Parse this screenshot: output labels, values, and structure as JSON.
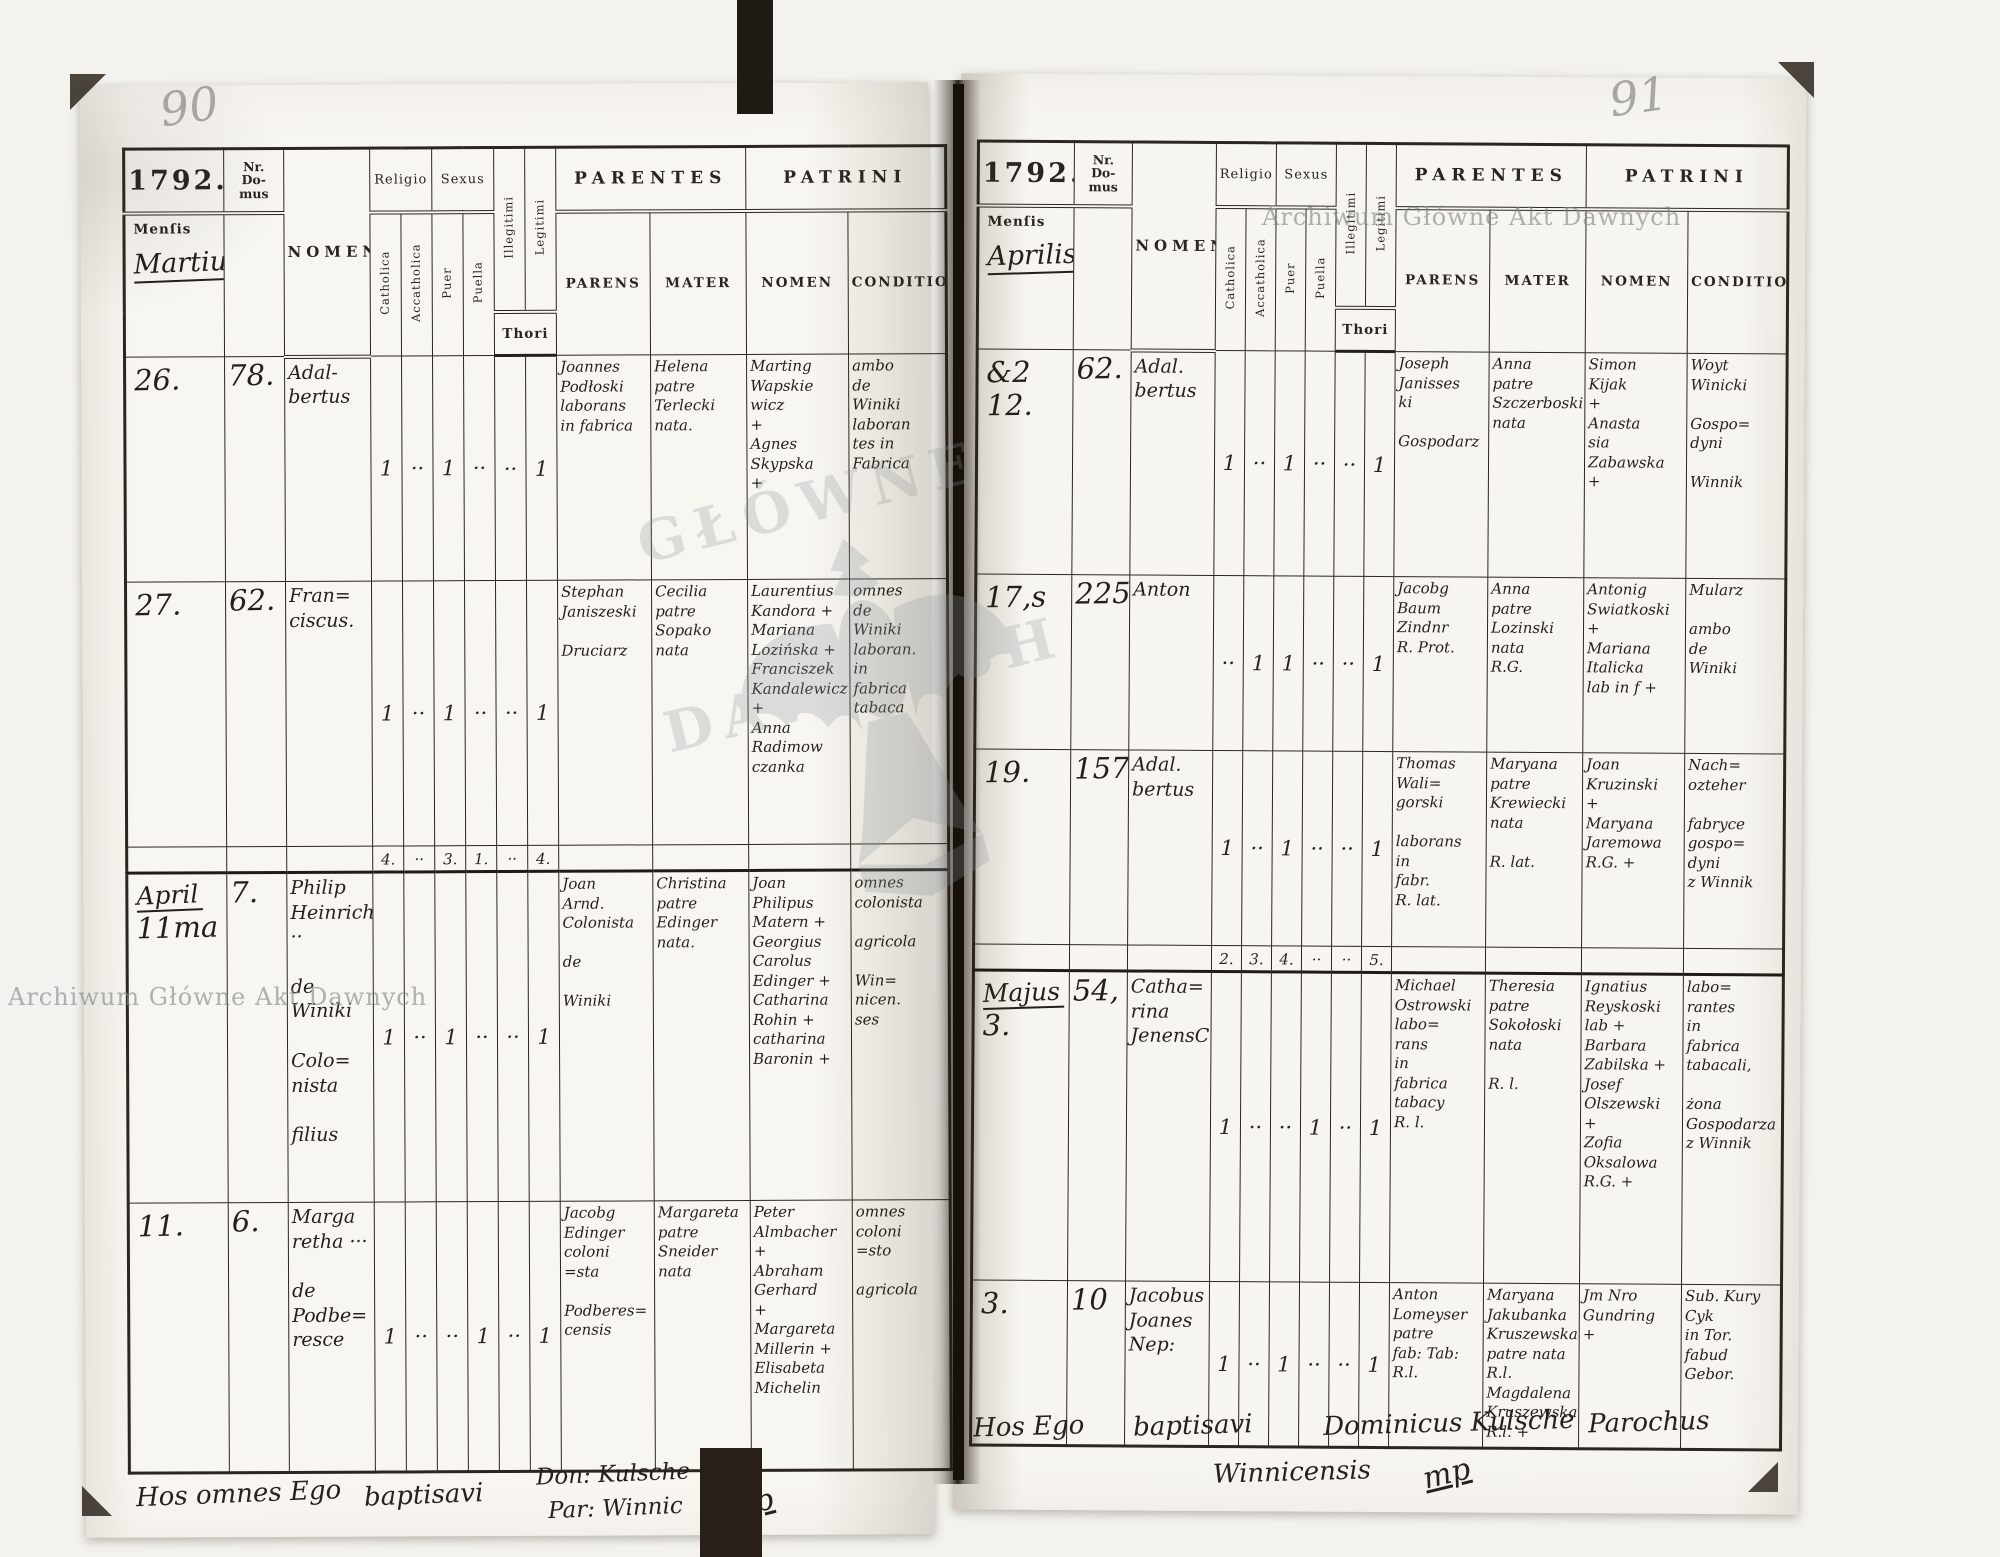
{
  "watermark": {
    "archive_name": "Archiwum Główne Akt Dawnych",
    "ghost_word_1": "GŁÓWNE",
    "ghost_word_2": "DAWNYCH"
  },
  "form_labels": {
    "year": "1792.",
    "nr_domus": "Nr.\nDo-\nmus",
    "mensis": "Menſis",
    "nomen": "NOMEN",
    "religio": "Religio",
    "sexus": "Sexus",
    "catholica": "Catholica",
    "accatholica": "Accatholica",
    "puer": "Puer",
    "puella": "Puella",
    "illegitimi": "Illegitimi",
    "legitimi": "Legitimi",
    "thori": "Thori",
    "parentes": "PARENTES",
    "parens": "PARENS",
    "mater": "MATER",
    "patrini": "PATRINI",
    "patrini_nomen": "NOMEN",
    "conditio": "CONDITIO"
  },
  "left_page": {
    "page_number": "90",
    "month": "Martius",
    "rows": [
      {
        "mensis": "26.",
        "nr": "78.",
        "nomen": "Adal-\nbertus",
        "tally": [
          "1",
          "··",
          "1",
          "··",
          "··",
          "1"
        ],
        "parens": "Joannes\nPodłoski\nlaborans\nin fabrica",
        "mater": "Helena\npatre\nTerlecki\nnata.",
        "patrini_nomen": "Marting\nWapskie\nwicz\n+\nAgnes\nSkypska\n+",
        "conditio": "ambo\nde\nWiniki\nlaboran\ntes in\nFabrica"
      },
      {
        "mensis": "27.",
        "nr": "62.",
        "nomen": "Fran=\nciscus.",
        "tally": [
          "1",
          "··",
          "1",
          "··",
          "··",
          "1"
        ],
        "parens": "Stephan\nJaniszeski\n\nDruciarz",
        "mater": "Cecilia\npatre\nSopako\nnata",
        "patrini_nomen": "Laurentius\nKandora +\nMariana\nLozińska +\nFranciszek\nKandalewicz\n+\nAnna\nRadimow\nczanka",
        "conditio": "omnes\nde\nWiniki\nlaboran.\nin\nfabrica\ntabaca"
      },
      {
        "mensis_month": "April",
        "mensis": "11ma",
        "nr": "7.",
        "nomen": "Philip\nHeinrich ··\n\nde\nWiniki\n\nColo=\nnista\n\nfilius",
        "tally": [
          "1",
          "··",
          "1",
          "··",
          "··",
          "1"
        ],
        "parens": "Joan\nArnd.\nColonista\n\nde\n\nWiniki",
        "mater": "Christina\npatre\nEdinger\nnata.",
        "patrini_nomen": "Joan\nPhilipus\nMatern +\nGeorgius\nCarolus\nEdinger +\nCatharina\nRohin +\ncatharina\nBaronin +",
        "conditio": "omnes\ncolonista\n\nagricola\n\nWin=\nnicen.\nses"
      },
      {
        "mensis": "11.",
        "nr": "6.",
        "nomen": "Marga\nretha ···\n\nde\nPodbe=\nresce",
        "tally": [
          "1",
          "··",
          "··",
          "1",
          "··",
          "1"
        ],
        "parens": "Jacobg\nEdinger\ncoloni\n=sta\n\nPodberes=\ncensis",
        "mater": "Margareta\npatre\nSneider\nnata",
        "patrini_nomen": "Peter\nAlmbacher\n+\nAbraham\nGerhard\n+\nMargareta\nMillerin +\nElisabeta\nMichelin",
        "conditio": "omnes\ncoloni\n=sto\n\nagricola"
      }
    ],
    "totals": [
      "4.",
      "··",
      "3.",
      "1.",
      "··",
      "4."
    ],
    "closing": {
      "p1": "Hos omnes Ego",
      "p2": "baptisavi",
      "p3": "Don: Kulsche",
      "p4": "Par: Winnic",
      "flourish": "mp"
    }
  },
  "right_page": {
    "page_number": "91",
    "month": "Aprilis",
    "rows": [
      {
        "mensis": "&2\n12.",
        "nr": "62.",
        "nomen": "Adal.\nbertus",
        "tally": [
          "1",
          "··",
          "1",
          "··",
          "··",
          "1"
        ],
        "parens": "Joseph\nJanisses\nki\n\nGospodarz",
        "mater": "Anna\npatre\nSzczerboski\nnata",
        "patrini_nomen": "Simon\nKijak\n+\nAnasta\nsia\nZabawska\n+",
        "conditio": "Woyt\nWinicki\n\nGospo=\ndyni\n\nWinnik"
      },
      {
        "mensis": "17,s",
        "nr": "225",
        "nomen": "Anton",
        "tally": [
          "··",
          "1",
          "1",
          "··",
          "··",
          "1"
        ],
        "parens": "Jacobg\nBaum\nZindnr\nR. Prot.",
        "mater": "Anna\npatre\nLozinski\nnata\nR.G.",
        "patrini_nomen": "Antonig\nSwiatkoski\n+\nMariana\nItalicka\nlab in f +",
        "conditio": "Mularz\n\nambo\nde\nWiniki"
      },
      {
        "mensis": "19.",
        "nr": "157.",
        "nomen": "Adal.\nbertus",
        "tally": [
          "1",
          "··",
          "1",
          "··",
          "··",
          "1"
        ],
        "parens": "Thomas\nWali=\ngorski\n\nlaborans\nin\nfabr.\nR. lat.",
        "mater": "Maryana\npatre\nKrewiecki\nnata\n\nR. lat.",
        "patrini_nomen": "Joan\nKruzinski\n+\nMaryana\nJaremowa\nR.G. +",
        "conditio": "Nach=\nozteher\n\nfabryce\ngospo=\ndyni\nz Winnik"
      },
      {
        "mensis_month": "Majus",
        "mensis": "3.",
        "nr": "54,",
        "nomen": "Catha=\nrina\nJenensC",
        "tally": [
          "1",
          "··",
          "··",
          "1",
          "··",
          "1"
        ],
        "parens": "Michael\nOstrowski\nlabo=\nrans\nin\nfabrica\ntabacy\nR. l.",
        "mater": "Theresia\npatre\nSokołoski\nnata\n\nR. l.",
        "patrini_nomen": "Ignatius\nReyskoski\nlab +\nBarbara\nZabilska +\nJosef\nOlszewski\n+\nZofia\nOksalowa\nR.G. +",
        "conditio": "labo=\nrantes\nin\nfabrica\ntabacali,\n\nżona\nGospodarza\nz Winnik"
      },
      {
        "mensis": "3.",
        "nr": "10",
        "nomen": "Jacobus\nJoanes\nNep:",
        "tally": [
          "1",
          "··",
          "1",
          "··",
          "··",
          "1"
        ],
        "parens": "Anton\nLomeyser\npatre\nfab: Tab:\nR.l.",
        "mater": "Maryana\nJakubanka\nKruszewska\npatre nata\nR.l.\nMagdalena\nKruszewska\nR.l. +",
        "patrini_nomen": "Jm Nro\nGundring\n+",
        "conditio": "Sub. Kury Cyk\nin Tor. fabud\nGebor."
      }
    ],
    "totals": [
      "2.",
      "3.",
      "4.",
      "··",
      "··",
      "5."
    ],
    "closing": {
      "p1": "Hos Ego",
      "p2": "baptisavi",
      "p3": "Dominicus Kulsche",
      "p4": "Parochus",
      "p5": "Winnicensis",
      "flourish": "mp"
    }
  }
}
